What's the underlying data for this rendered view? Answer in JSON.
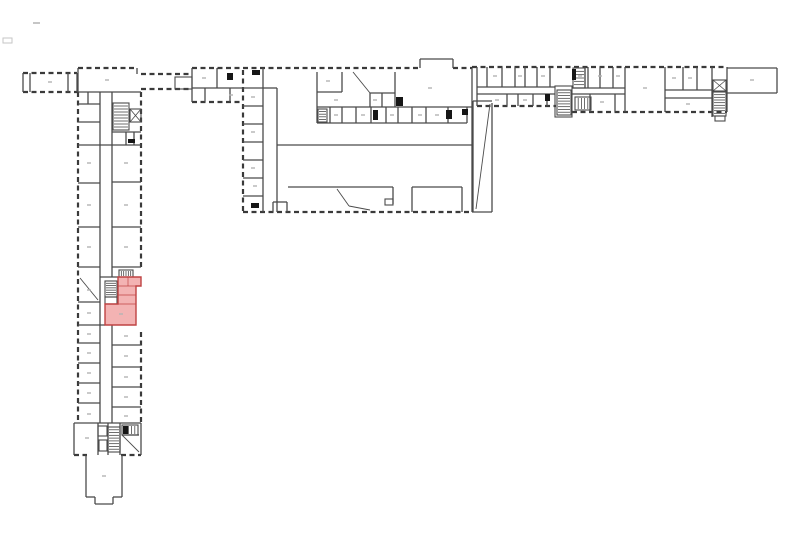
{
  "meta": {
    "width": 800,
    "height": 533
  },
  "colors": {
    "background": "#ffffff",
    "wall": "#4a4a4a",
    "wall_dark": "#3a3a3a",
    "black": "#161616",
    "label": "#b4b4b4",
    "artifact": "#c6c6c6",
    "highlight_fill": "#f0a0a0",
    "highlight_stroke": "#bf4343"
  },
  "plan": {
    "dashed_walls": [
      [
        23,
        73,
        77,
        73
      ],
      [
        23,
        92,
        77,
        92
      ],
      [
        78,
        68,
        137,
        68
      ],
      [
        78,
        92,
        78,
        423
      ],
      [
        141,
        92,
        141,
        268
      ],
      [
        141,
        332,
        141,
        423
      ],
      [
        74,
        455,
        87,
        455
      ],
      [
        121,
        455,
        141,
        455
      ],
      [
        141,
        74,
        192,
        74
      ],
      [
        141,
        89,
        192,
        89
      ],
      [
        192,
        68,
        243,
        68
      ],
      [
        192,
        102,
        242,
        102
      ],
      [
        243,
        68,
        420,
        68
      ],
      [
        453,
        68,
        472,
        68
      ],
      [
        243,
        70,
        243,
        212
      ],
      [
        243,
        212,
        472,
        212
      ],
      [
        472,
        67,
        727,
        67
      ],
      [
        477,
        106,
        556,
        106
      ],
      [
        572,
        112,
        727,
        112
      ]
    ],
    "solid_walls": [
      [
        23,
        73,
        23,
        92
      ],
      [
        30,
        73,
        30,
        92
      ],
      [
        68,
        73,
        68,
        92
      ],
      [
        77,
        73,
        77,
        92
      ],
      [
        78,
        68,
        78,
        92
      ],
      [
        137,
        68,
        137,
        74
      ],
      [
        78,
        92,
        141,
        92
      ],
      [
        78,
        104,
        100,
        104
      ],
      [
        88,
        92,
        88,
        104
      ],
      [
        78,
        122,
        100,
        122
      ],
      [
        100,
        92,
        100,
        423
      ],
      [
        112,
        92,
        112,
        277
      ],
      [
        112,
        325,
        112,
        423
      ],
      [
        112,
        132,
        141,
        132
      ],
      [
        126,
        132,
        126,
        145
      ],
      [
        134,
        132,
        134,
        145
      ],
      [
        78,
        145,
        141,
        145
      ],
      [
        78,
        183,
        100,
        183
      ],
      [
        78,
        227,
        100,
        227
      ],
      [
        78,
        267,
        100,
        267
      ],
      [
        78,
        302,
        100,
        302
      ],
      [
        78,
        325,
        105,
        325
      ],
      [
        78,
        343,
        100,
        343
      ],
      [
        78,
        363,
        100,
        363
      ],
      [
        78,
        383,
        100,
        383
      ],
      [
        78,
        403,
        100,
        403
      ],
      [
        112,
        182,
        141,
        182
      ],
      [
        112,
        227,
        141,
        227
      ],
      [
        112,
        267,
        141,
        267
      ],
      [
        100,
        277,
        118,
        277
      ],
      [
        112,
        345,
        141,
        345
      ],
      [
        112,
        367,
        141,
        367
      ],
      [
        112,
        387,
        141,
        387
      ],
      [
        112,
        407,
        141,
        407
      ],
      [
        74,
        423,
        141,
        423
      ],
      [
        74,
        423,
        74,
        455
      ],
      [
        141,
        423,
        141,
        455
      ],
      [
        98,
        423,
        98,
        455
      ],
      [
        108,
        423,
        108,
        455
      ],
      [
        120,
        423,
        120,
        455
      ],
      [
        122,
        435,
        139,
        435
      ],
      [
        86,
        455,
        86,
        497
      ],
      [
        122,
        455,
        122,
        497
      ],
      [
        86,
        497,
        95,
        497
      ],
      [
        113,
        497,
        122,
        497
      ],
      [
        95,
        497,
        95,
        504
      ],
      [
        113,
        497,
        113,
        504
      ],
      [
        95,
        504,
        113,
        504
      ],
      [
        192,
        68,
        192,
        102
      ],
      [
        217,
        68,
        217,
        88
      ],
      [
        192,
        88,
        243,
        88
      ],
      [
        205,
        88,
        205,
        102
      ],
      [
        230,
        88,
        230,
        102
      ],
      [
        472,
        68,
        472,
        212
      ],
      [
        420,
        59,
        420,
        68
      ],
      [
        420,
        59,
        453,
        59
      ],
      [
        453,
        59,
        453,
        68
      ],
      [
        263,
        68,
        263,
        212
      ],
      [
        277,
        88,
        277,
        212
      ],
      [
        243,
        88,
        263,
        88
      ],
      [
        243,
        106,
        263,
        106
      ],
      [
        243,
        124,
        263,
        124
      ],
      [
        243,
        142,
        263,
        142
      ],
      [
        243,
        160,
        263,
        160
      ],
      [
        243,
        178,
        263,
        178
      ],
      [
        243,
        196,
        263,
        196
      ],
      [
        263,
        88,
        277,
        88
      ],
      [
        317,
        72,
        317,
        123
      ],
      [
        317,
        92,
        342,
        92
      ],
      [
        342,
        72,
        342,
        92
      ],
      [
        370,
        93,
        370,
        107
      ],
      [
        395,
        72,
        395,
        107
      ],
      [
        370,
        93,
        395,
        93
      ],
      [
        382,
        93,
        382,
        107
      ],
      [
        317,
        107,
        472,
        107
      ],
      [
        317,
        123,
        467,
        123
      ],
      [
        467,
        107,
        467,
        123
      ],
      [
        330,
        107,
        330,
        123
      ],
      [
        342,
        107,
        342,
        123
      ],
      [
        356,
        107,
        356,
        123
      ],
      [
        371,
        107,
        371,
        123
      ],
      [
        386,
        107,
        386,
        123
      ],
      [
        398,
        107,
        398,
        123
      ],
      [
        412,
        107,
        412,
        123
      ],
      [
        426,
        107,
        426,
        123
      ],
      [
        448,
        107,
        448,
        123
      ],
      [
        277,
        145,
        472,
        145
      ],
      [
        288,
        187,
        393,
        187
      ],
      [
        393,
        187,
        393,
        204
      ],
      [
        412,
        187,
        462,
        187
      ],
      [
        412,
        187,
        412,
        212
      ],
      [
        462,
        187,
        462,
        212
      ],
      [
        273,
        202,
        273,
        212
      ],
      [
        287,
        202,
        287,
        212
      ],
      [
        273,
        202,
        287,
        202
      ],
      [
        473,
        101,
        473,
        212
      ],
      [
        492,
        103,
        492,
        212
      ],
      [
        473,
        101,
        492,
        101
      ],
      [
        472,
        212,
        492,
        212
      ],
      [
        477,
        67,
        477,
        106
      ],
      [
        487,
        67,
        487,
        87
      ],
      [
        502,
        67,
        502,
        87
      ],
      [
        515,
        67,
        515,
        87
      ],
      [
        525,
        67,
        525,
        87
      ],
      [
        537,
        67,
        537,
        87
      ],
      [
        550,
        67,
        550,
        87
      ],
      [
        585,
        67,
        585,
        88
      ],
      [
        588,
        67,
        588,
        88
      ],
      [
        600,
        67,
        600,
        88
      ],
      [
        613,
        67,
        613,
        88
      ],
      [
        625,
        67,
        625,
        112
      ],
      [
        665,
        67,
        665,
        112
      ],
      [
        683,
        67,
        683,
        90
      ],
      [
        697,
        67,
        697,
        90
      ],
      [
        712,
        67,
        712,
        117
      ],
      [
        477,
        87,
        555,
        87
      ],
      [
        572,
        88,
        625,
        88
      ],
      [
        665,
        90,
        712,
        90
      ],
      [
        477,
        94,
        555,
        94
      ],
      [
        572,
        94,
        625,
        94
      ],
      [
        665,
        98,
        712,
        98
      ],
      [
        507,
        94,
        507,
        106
      ],
      [
        518,
        94,
        518,
        106
      ],
      [
        533,
        94,
        533,
        106
      ],
      [
        547,
        94,
        547,
        106
      ],
      [
        590,
        94,
        590,
        112
      ],
      [
        615,
        94,
        615,
        112
      ],
      [
        727,
        67,
        727,
        112
      ],
      [
        727,
        68,
        777,
        68
      ],
      [
        777,
        68,
        777,
        93
      ],
      [
        727,
        93,
        777,
        93
      ]
    ],
    "rects": [
      [
        175,
        77,
        17,
        12
      ],
      [
        385,
        199,
        8,
        6
      ],
      [
        98,
        426,
        9,
        10
      ],
      [
        99,
        440,
        8,
        11
      ],
      [
        715,
        116,
        10,
        5
      ],
      [
        105,
        297,
        12,
        7
      ],
      [
        555,
        86,
        17,
        31
      ]
    ],
    "stairs": [
      {
        "x": 113,
        "y": 103,
        "w": 16,
        "h": 27,
        "steps": 8,
        "dir": "h"
      },
      {
        "x": 105,
        "y": 281,
        "w": 12,
        "h": 16,
        "steps": 6,
        "dir": "h"
      },
      {
        "x": 108,
        "y": 427,
        "w": 12,
        "h": 25,
        "steps": 8,
        "dir": "h"
      },
      {
        "x": 557,
        "y": 90,
        "w": 14,
        "h": 25,
        "steps": 8,
        "dir": "h"
      },
      {
        "x": 713,
        "y": 92,
        "w": 13,
        "h": 24,
        "steps": 8,
        "dir": "h"
      },
      {
        "x": 318,
        "y": 109,
        "w": 9,
        "h": 13,
        "steps": 4,
        "dir": "h"
      },
      {
        "x": 119,
        "y": 270,
        "w": 14,
        "h": 7,
        "steps": 5,
        "dir": "v"
      },
      {
        "x": 575,
        "y": 97,
        "w": 16,
        "h": 13,
        "steps": 4,
        "dir": "v"
      },
      {
        "x": 122,
        "y": 425,
        "w": 16,
        "h": 10,
        "steps": 4,
        "dir": "v"
      },
      {
        "x": 573,
        "y": 68,
        "w": 12,
        "h": 20,
        "steps": 5,
        "dir": "h"
      }
    ],
    "elevators": [
      [
        130,
        109,
        11,
        13
      ],
      [
        713,
        80,
        13,
        11
      ]
    ],
    "diagonals": [
      [
        353,
        72,
        370,
        93
      ],
      [
        337,
        189,
        349,
        206
      ],
      [
        349,
        206,
        370,
        210
      ],
      [
        490,
        104,
        476,
        209
      ],
      [
        122,
        435,
        139,
        452
      ],
      [
        80,
        278,
        98,
        300
      ]
    ],
    "black_marks": [
      [
        252,
        70,
        8,
        5
      ],
      [
        251,
        203,
        8,
        5
      ],
      [
        227,
        73,
        6,
        7
      ],
      [
        396,
        97,
        7,
        9
      ],
      [
        373,
        110,
        5,
        10
      ],
      [
        446,
        110,
        6,
        9
      ],
      [
        462,
        109,
        6,
        6
      ],
      [
        545,
        94,
        5,
        7
      ],
      [
        572,
        69,
        4,
        11
      ],
      [
        128,
        139,
        7,
        4
      ],
      [
        123,
        426,
        5,
        8
      ]
    ],
    "highlight": {
      "points": "118,277 141,277 141,286 136,286 136,325 105,325 105,304 118,304",
      "inner_walls": [
        [
          118,
          286,
          141,
          286
        ],
        [
          118,
          295,
          136,
          295
        ],
        [
          105,
          304,
          136,
          304
        ],
        [
          128,
          277,
          128,
          286
        ]
      ]
    },
    "label_marks": [
      [
        50,
        82
      ],
      [
        107,
        80
      ],
      [
        89,
        163
      ],
      [
        89,
        205
      ],
      [
        89,
        247
      ],
      [
        89,
        290
      ],
      [
        89,
        313
      ],
      [
        89,
        334
      ],
      [
        89,
        353
      ],
      [
        89,
        373
      ],
      [
        89,
        393
      ],
      [
        89,
        414
      ],
      [
        126,
        163
      ],
      [
        126,
        205
      ],
      [
        126,
        247
      ],
      [
        126,
        336
      ],
      [
        126,
        356
      ],
      [
        126,
        377
      ],
      [
        126,
        397
      ],
      [
        126,
        416
      ],
      [
        121,
        314
      ],
      [
        87,
        438
      ],
      [
        104,
        476
      ],
      [
        204,
        78
      ],
      [
        231,
        95
      ],
      [
        328,
        81
      ],
      [
        336,
        100
      ],
      [
        375,
        100
      ],
      [
        430,
        88
      ],
      [
        336,
        115
      ],
      [
        363,
        115
      ],
      [
        392,
        115
      ],
      [
        420,
        115
      ],
      [
        437,
        115
      ],
      [
        253,
        97
      ],
      [
        253,
        132
      ],
      [
        253,
        168
      ],
      [
        255,
        186
      ],
      [
        495,
        76
      ],
      [
        520,
        76
      ],
      [
        543,
        76
      ],
      [
        580,
        76
      ],
      [
        600,
        76
      ],
      [
        618,
        76
      ],
      [
        645,
        88
      ],
      [
        674,
        78
      ],
      [
        690,
        78
      ],
      [
        497,
        100
      ],
      [
        525,
        100
      ],
      [
        602,
        102
      ],
      [
        688,
        104
      ],
      [
        752,
        80
      ]
    ],
    "artifacts": {
      "dash": [
        33,
        22,
        7,
        2
      ],
      "box": [
        3,
        38,
        9,
        5
      ]
    }
  }
}
